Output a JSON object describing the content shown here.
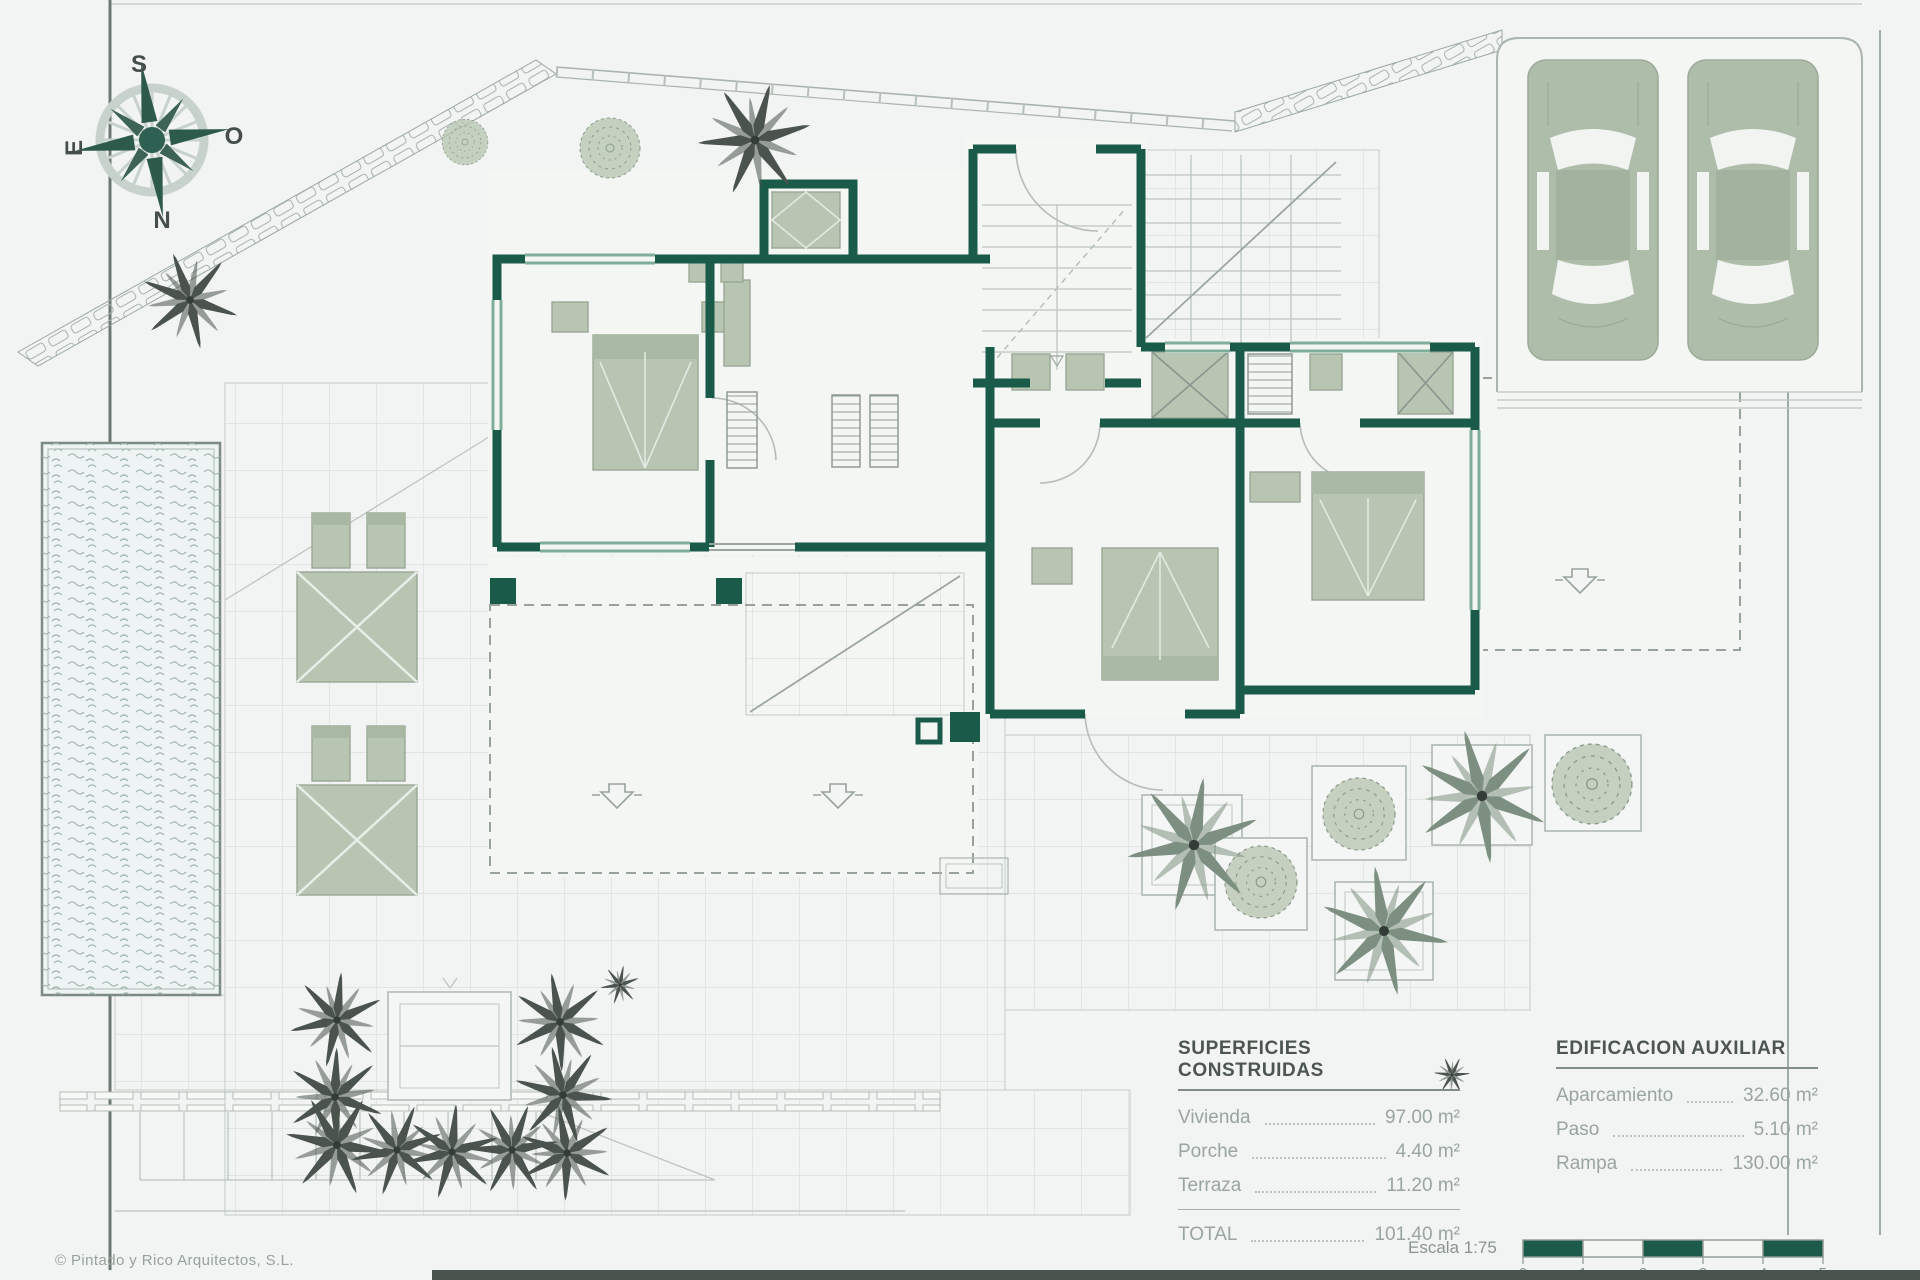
{
  "plan": {
    "kind": "villa site and floor plan",
    "scale": "1:75"
  },
  "compass": {
    "top": "S",
    "right": "O",
    "bottom": "N",
    "left": "E"
  },
  "tables": {
    "superficies": {
      "title": "SUPERFICIES CONSTRUIDAS",
      "rows": [
        {
          "label": "Vivienda",
          "value": "97.00 m²"
        },
        {
          "label": "Porche",
          "value": "4.40 m²"
        },
        {
          "label": "Terraza",
          "value": "11.20 m²"
        }
      ],
      "total_label": "TOTAL",
      "total_value": "101.40 m²"
    },
    "auxiliar": {
      "title": "EDIFICACION AUXILIAR",
      "rows": [
        {
          "label": "Aparcamiento",
          "value": "32.60 m²"
        },
        {
          "label": "Paso",
          "value": "5.10 m²"
        },
        {
          "label": "Rampa",
          "value": "130.00 m²"
        }
      ]
    }
  },
  "scalebar": {
    "label": "Escala 1:75",
    "ticks": [
      "0",
      "1",
      "2",
      "3",
      "4",
      "5 m"
    ]
  },
  "footer": {
    "copyright": "© Pintado y Rico Arquitectos, S.L."
  },
  "colors": {
    "background": "#f1f4f2",
    "wall": "#1a5a49",
    "window": "#7fae9a",
    "furniture": "#b7c5b2",
    "bush": "#b9c7b3",
    "palm_dark": "#4a534d",
    "palm_light": "#7d8f80",
    "car": "#aebcaa",
    "water_line": "#9fb2ac",
    "scale_green": "#1c5b4a",
    "text_dark": "#4d5550",
    "text_grey": "#9aa59f"
  }
}
